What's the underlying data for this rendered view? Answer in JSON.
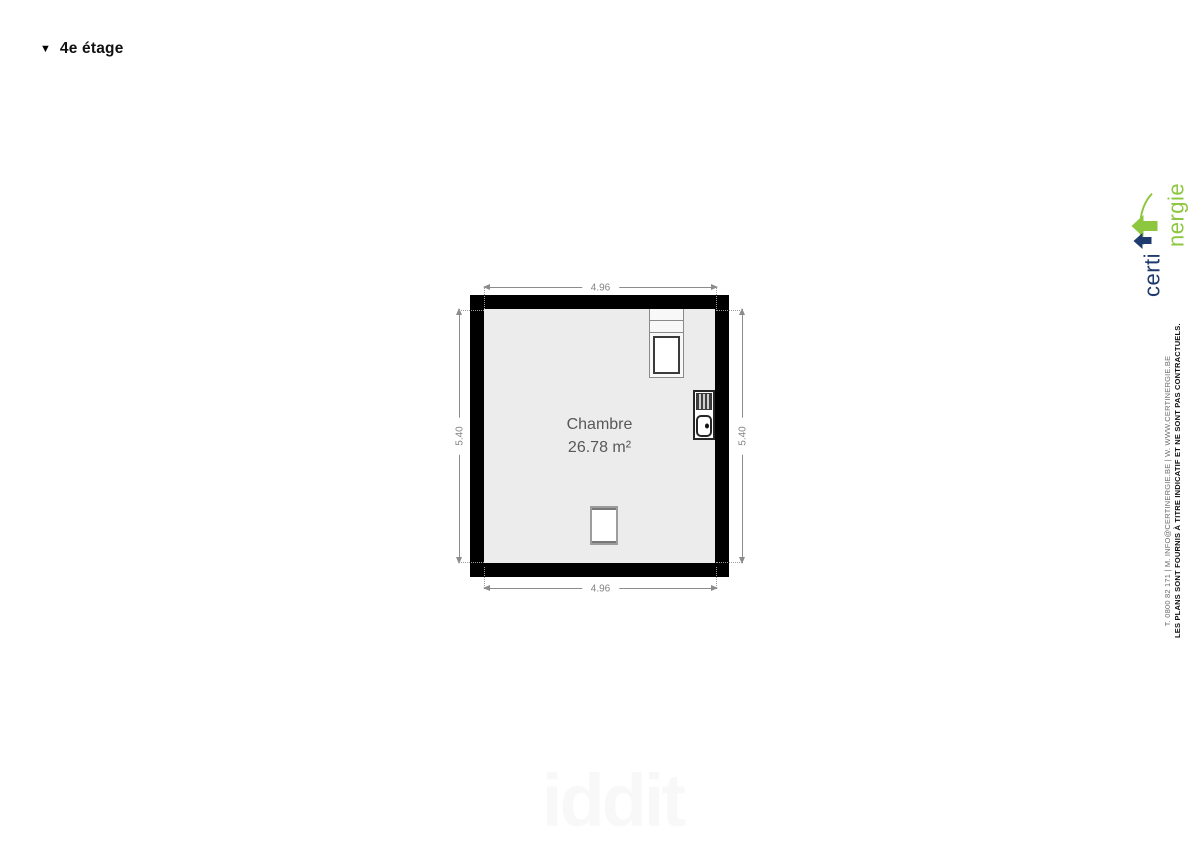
{
  "page": {
    "collapse_icon": "▼",
    "title": "4e étage"
  },
  "plan": {
    "room": {
      "name": "Chambre",
      "area": "26.78 m²"
    },
    "dims": {
      "top": "4.96",
      "bottom": "4.96",
      "left": "5.40",
      "right": "5.40"
    },
    "fixtures": [
      "kitchen-unit",
      "sink-unit",
      "skylight"
    ]
  },
  "branding": {
    "logo": {
      "part1": "certi",
      "part2": "nergie"
    },
    "disclaimer": "LES PLANS SONT FOURNIS À TITRE INDICATIF ET NE SONT PAS CONTRACTUELS.",
    "contact": "T. 0800 82 171 | M. INFO@CERTINERGIE.BE | W. WWW.CERTINERGIE.BE"
  },
  "watermark": "iddit",
  "colors": {
    "wall": "#000000",
    "floor": "#ececec",
    "dimension": "#8c8c8c",
    "room_label": "#585858",
    "logo_navy": "#1e3a6e",
    "logo_green": "#8dc63f"
  }
}
